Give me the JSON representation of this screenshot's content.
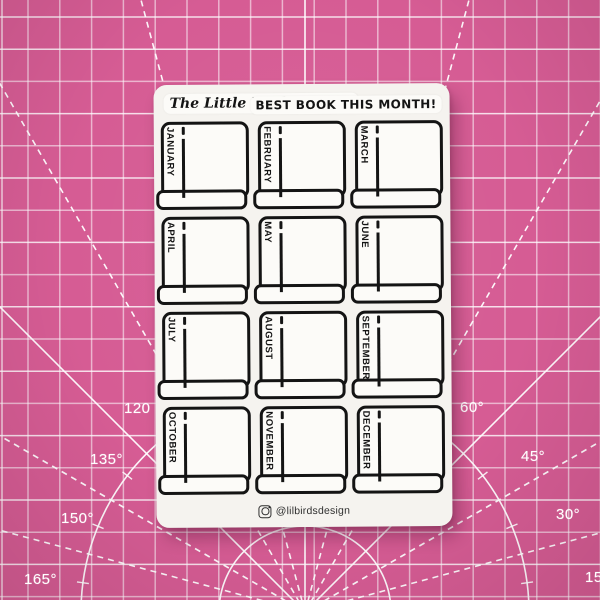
{
  "colors": {
    "mat_pink": "#d65c94",
    "grid_line": "#ffffff",
    "sheet_bg": "#f5f3ef",
    "sticker_bg": "#fcfbf8",
    "ink": "#141414",
    "handle_text": "#2f2f2f"
  },
  "mat": {
    "angles": [
      "120",
      "135°",
      "150°",
      "165°",
      "60°",
      "45°",
      "30°",
      "15"
    ]
  },
  "sheet": {
    "brand": "The Little Bird Designs",
    "title": "BEST BOOK THIS MONTH!",
    "months": [
      "JANUARY",
      "FEBRUARY",
      "MARCH",
      "APRIL",
      "MAY",
      "JUNE",
      "JULY",
      "AUGUST",
      "SEPTEMBER",
      "OCTOBER",
      "NOVEMBER",
      "DECEMBER"
    ],
    "handle": "@lilbirdsdesign",
    "icons": {
      "instagram": "instagram-icon"
    }
  }
}
